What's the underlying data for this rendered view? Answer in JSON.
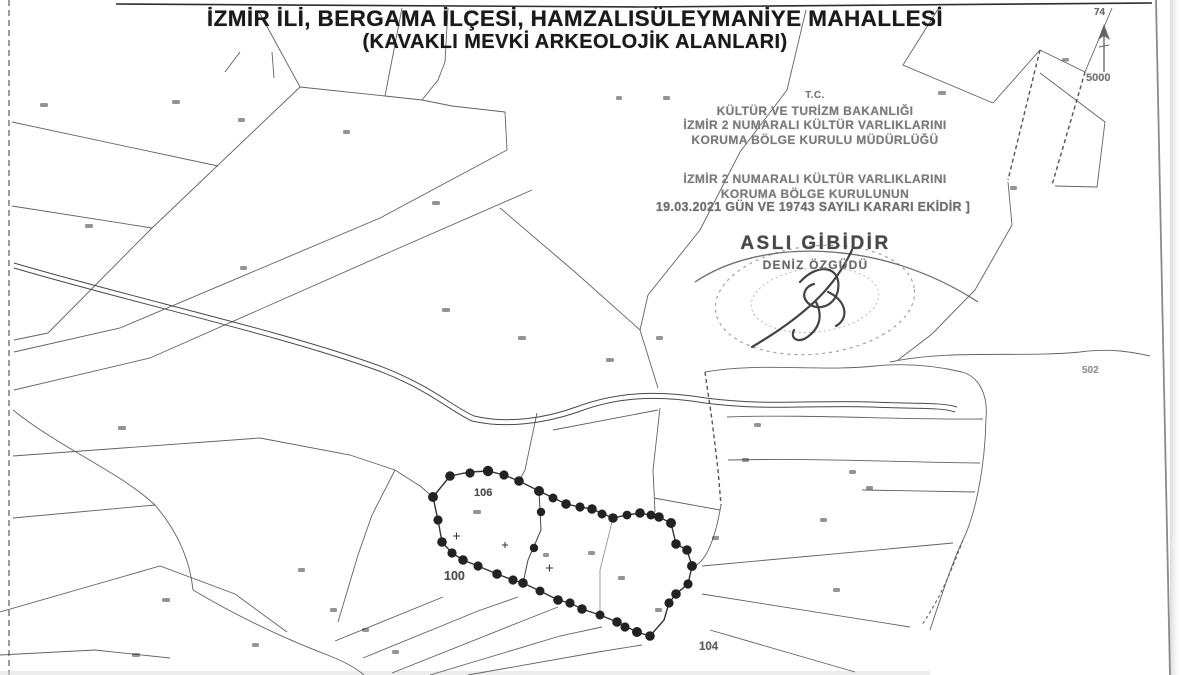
{
  "document": {
    "title_line1": "İZMİR İLİ, BERGAMA İLÇESİ, HAMZALISÜLEYMANİYE MAHALLESİ",
    "title_line2": "(KAVAKLI MEVKİ ARKEOLOJİK ALANLARI)"
  },
  "approval_stamp": {
    "line1": "T.C.",
    "line2": "KÜLTÜR VE TURİZM BAKANLIĞI",
    "line3": "İZMİR 2 NUMARALI KÜLTÜR VARLIKLARINI",
    "line4": "KORUMA BÖLGE KURULU MÜDÜRLÜĞÜ",
    "line5": "İZMİR 2 NUMARALI KÜLTÜR VARLIKLARINI",
    "line6": "KORUMA BÖLGE KURULUNUN",
    "line7": "19.03.2021 GÜN VE 19743 SAYILI KARARI EKİDİR ]"
  },
  "certification": {
    "text": "ASLI GİBİDİR",
    "name": "DENİZ ÖZGÜDÜ"
  },
  "north_arrow": {
    "top_label": "74",
    "scale_label": "5000"
  },
  "map_labels": {
    "parcel_106": "106",
    "parcel_100": "100",
    "parcel_104": "104",
    "parcel_502": "502"
  },
  "colors": {
    "paper": "#ffffff",
    "ink": "#3a3a3a",
    "stamp_ink": "#7b7b7b"
  }
}
